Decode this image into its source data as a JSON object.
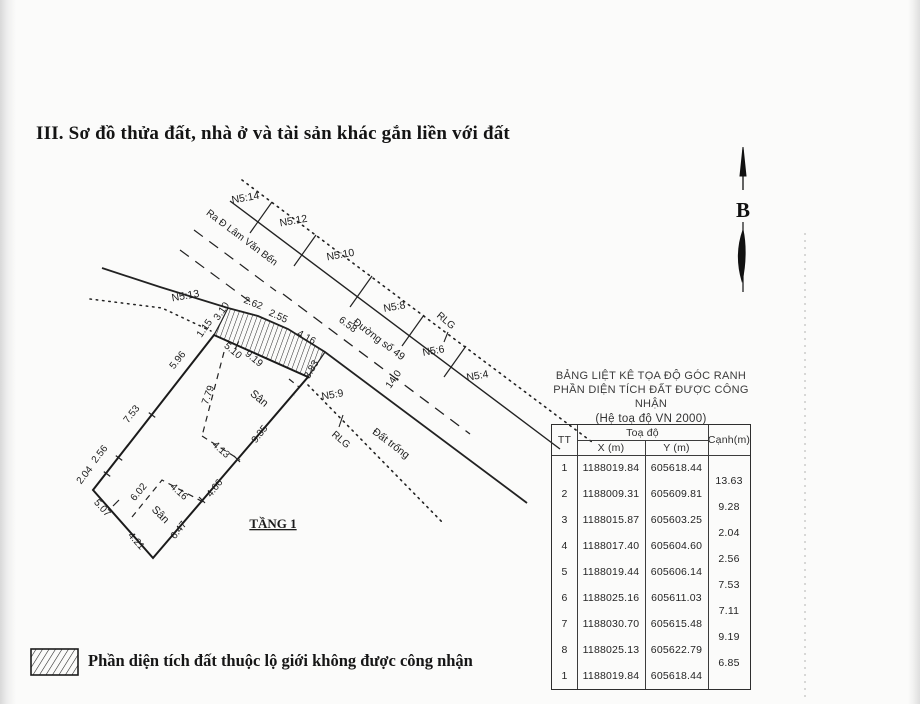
{
  "document": {
    "title": "III. Sơ đồ thửa đất, nhà ở và tài sản khác gắn liền với đất"
  },
  "compass": {
    "label": "B"
  },
  "legend": {
    "text": "Phần diện tích đất thuộc lộ giới không được công nhận"
  },
  "coordinate_table": {
    "title_line1": "BẢNG LIỆT KÊ TỌA ĐỘ GÓC RANH",
    "title_line2": "PHẦN DIỆN TÍCH ĐẤT ĐƯỢC CÔNG NHẬN",
    "title_line3": "(Hệ toạ độ VN 2000)",
    "headers": {
      "tt": "TT",
      "toado": "Toạ độ",
      "x": "X (m)",
      "y": "Y (m)",
      "canh": "Cạnh(m)"
    },
    "rows": [
      {
        "tt": "1",
        "x": "1188019.84",
        "y": "605618.44"
      },
      {
        "tt": "2",
        "x": "1188009.31",
        "y": "605609.81"
      },
      {
        "tt": "3",
        "x": "1188015.87",
        "y": "605603.25"
      },
      {
        "tt": "4",
        "x": "1188017.40",
        "y": "605604.60"
      },
      {
        "tt": "5",
        "x": "1188019.44",
        "y": "605606.14"
      },
      {
        "tt": "6",
        "x": "1188025.16",
        "y": "605611.03"
      },
      {
        "tt": "7",
        "x": "1188030.70",
        "y": "605615.48"
      },
      {
        "tt": "8",
        "x": "1188025.13",
        "y": "605622.79"
      },
      {
        "tt": "1",
        "x": "1188019.84",
        "y": "605618.44"
      }
    ],
    "canh": [
      "13.63",
      "9.28",
      "2.04",
      "2.56",
      "7.53",
      "7.11",
      "9.19",
      "6.85"
    ]
  },
  "diagram": {
    "labels": [
      {
        "t": "N5:14",
        "x": 246,
        "y": 201,
        "r": -10,
        "s": 10.5,
        "n": "lot-label-n5-14"
      },
      {
        "t": "N5:12",
        "x": 294,
        "y": 224,
        "r": -10,
        "s": 10.5,
        "n": "lot-label-n5-12"
      },
      {
        "t": "N5:10",
        "x": 341,
        "y": 258,
        "r": -10,
        "s": 10.5,
        "n": "lot-label-n5-10"
      },
      {
        "t": "N5:8",
        "x": 395,
        "y": 310,
        "r": -10,
        "s": 10.5,
        "n": "lot-label-n5-8"
      },
      {
        "t": "N5:6",
        "x": 434,
        "y": 354,
        "r": -10,
        "s": 10.5,
        "n": "lot-label-n5-6"
      },
      {
        "t": "N5:4",
        "x": 478,
        "y": 379,
        "r": -10,
        "s": 10.5,
        "n": "lot-label-n5-4"
      },
      {
        "t": "N5:13",
        "x": 186,
        "y": 299,
        "r": -10,
        "s": 10.5,
        "n": "lot-label-n5-13"
      },
      {
        "t": "N5:9",
        "x": 333,
        "y": 398,
        "r": -10,
        "s": 10.5,
        "n": "lot-label-n5-9"
      },
      {
        "t": "Ra Đ Lâm Văn Bến",
        "x": 240,
        "y": 240,
        "r": 37,
        "s": 10,
        "n": "road-label-lam-van-ben"
      },
      {
        "t": "Đường số 49",
        "x": 377,
        "y": 342,
        "r": 37,
        "s": 10.5,
        "n": "road-label-duong-so-49"
      },
      {
        "t": "6.58",
        "x": 346,
        "y": 327,
        "r": 37,
        "s": 10,
        "n": "dim-label"
      },
      {
        "t": "14,0",
        "x": 396,
        "y": 381,
        "r": -55,
        "s": 10,
        "n": "dim-label"
      },
      {
        "t": "RLG",
        "x": 444,
        "y": 323,
        "r": 40,
        "s": 10,
        "n": "rlg-label-far"
      },
      {
        "t": "RLG",
        "x": 339,
        "y": 442,
        "r": 40,
        "s": 10,
        "n": "rlg-label-near"
      },
      {
        "t": "Đất trống",
        "x": 389,
        "y": 446,
        "r": 37,
        "s": 10.5,
        "n": "vacant-land-label"
      },
      {
        "t": "2.62",
        "x": 252,
        "y": 306,
        "r": 22,
        "s": 10,
        "n": "dim-label"
      },
      {
        "t": "2.55",
        "x": 277,
        "y": 319,
        "r": 24,
        "s": 10,
        "n": "dim-label"
      },
      {
        "t": "4.16",
        "x": 305,
        "y": 340,
        "r": 28,
        "s": 10,
        "n": "dim-label"
      },
      {
        "t": "3.10",
        "x": 224,
        "y": 313,
        "r": -55,
        "s": 10,
        "n": "dim-label"
      },
      {
        "t": "1.15",
        "x": 207,
        "y": 330,
        "r": -55,
        "s": 10,
        "n": "dim-label"
      },
      {
        "t": "3.83",
        "x": 314,
        "y": 371,
        "r": -60,
        "s": 10,
        "n": "dim-label"
      },
      {
        "t": "5.10",
        "x": 231,
        "y": 353,
        "r": 40,
        "s": 10,
        "n": "dim-label"
      },
      {
        "t": "9.19",
        "x": 252,
        "y": 361,
        "r": 40,
        "s": 10,
        "n": "dim-label"
      },
      {
        "t": "5.96",
        "x": 180,
        "y": 362,
        "r": -52,
        "s": 10,
        "n": "dim-label"
      },
      {
        "t": "7.53",
        "x": 134,
        "y": 416,
        "r": -52,
        "s": 10,
        "n": "dim-label"
      },
      {
        "t": "2.56",
        "x": 102,
        "y": 456,
        "r": -52,
        "s": 10,
        "n": "dim-label"
      },
      {
        "t": "2.04",
        "x": 87,
        "y": 477,
        "r": -52,
        "s": 10,
        "n": "dim-label"
      },
      {
        "t": "5.07",
        "x": 100,
        "y": 510,
        "r": 48,
        "s": 10,
        "n": "dim-label"
      },
      {
        "t": "4.21",
        "x": 134,
        "y": 543,
        "r": 48,
        "s": 10,
        "n": "dim-label"
      },
      {
        "t": "6.47",
        "x": 181,
        "y": 532,
        "r": -52,
        "s": 10,
        "n": "dim-label"
      },
      {
        "t": "4.66",
        "x": 217,
        "y": 490,
        "r": -52,
        "s": 10,
        "n": "dim-label"
      },
      {
        "t": "9.35",
        "x": 262,
        "y": 436,
        "r": -52,
        "s": 10,
        "n": "dim-label"
      },
      {
        "t": "7.79",
        "x": 211,
        "y": 396,
        "r": -70,
        "s": 10,
        "n": "dim-label"
      },
      {
        "t": "4.13",
        "x": 219,
        "y": 452,
        "r": 42,
        "s": 10,
        "n": "dim-label"
      },
      {
        "t": "6.02",
        "x": 141,
        "y": 494,
        "r": -50,
        "s": 10,
        "n": "dim-label"
      },
      {
        "t": "4.16",
        "x": 177,
        "y": 494,
        "r": 42,
        "s": 10,
        "n": "dim-label"
      },
      {
        "t": "Sân",
        "x": 257,
        "y": 401,
        "r": 40,
        "s": 11,
        "n": "yard-label"
      },
      {
        "t": "Sân",
        "x": 158,
        "y": 517,
        "r": 45,
        "s": 11,
        "n": "yard-label"
      },
      {
        "t": "TẦNG 1",
        "x": 273,
        "y": 528,
        "r": 0,
        "s": 13,
        "n": "floor-label",
        "serif_bold": true
      }
    ]
  }
}
